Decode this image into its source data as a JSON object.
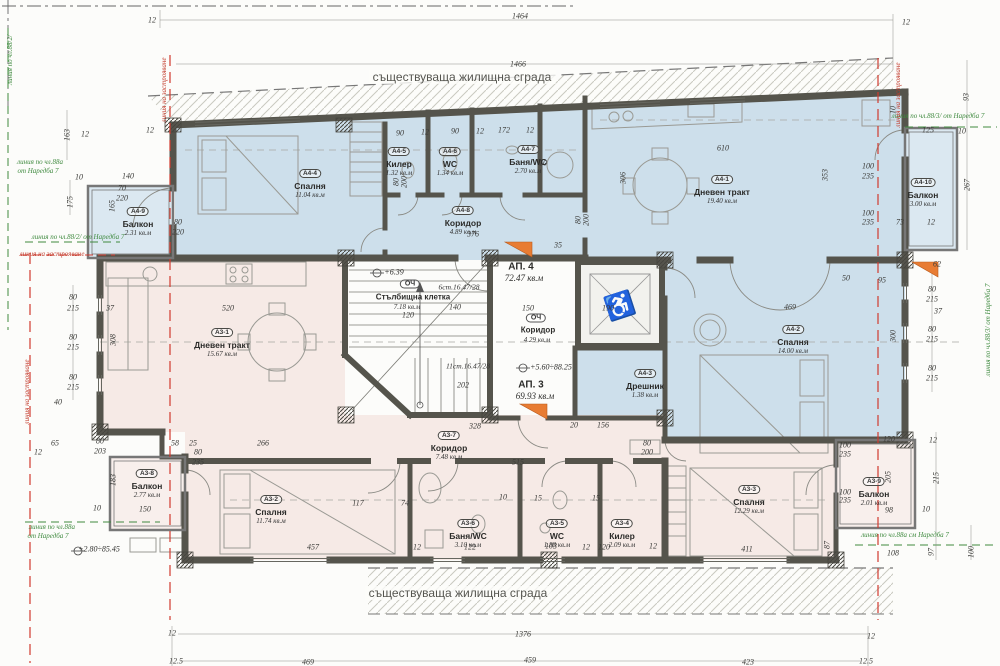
{
  "texts": {
    "existing_top": "съществуваща жилищна сграда",
    "existing_bottom": "съществуваща жилищна сграда"
  },
  "colors": {
    "apartment4_fill": "#cddfeb",
    "apartment3_fill": "#f6eae6",
    "wall": "#55544c",
    "regulation_green": "#3f8a3f",
    "building_line_red": "#c23b2c",
    "section_marker_orange": "#e87c33"
  },
  "apartments": [
    {
      "label": "АП. 4",
      "area": "72.47 кв.м"
    },
    {
      "label": "АП. 3",
      "area": "69.93 кв.м"
    }
  ],
  "rooms": [
    {
      "id": "A4-1",
      "name": "Дневен тракт",
      "area": "19.40 кв.м",
      "x": 722,
      "y": 168
    },
    {
      "id": "A4-2",
      "name": "Спалня",
      "area": "14.00 кв.м",
      "x": 793,
      "y": 318
    },
    {
      "id": "A4-3",
      "name": "Дрешник",
      "area": "1.38 кв.м",
      "x": 645,
      "y": 362
    },
    {
      "id": "A4-4",
      "name": "Спалня",
      "area": "11.04 кв.м",
      "x": 310,
      "y": 162
    },
    {
      "id": "A4-5",
      "name": "Килер",
      "area": "1.32 кв.м",
      "x": 399,
      "y": 140
    },
    {
      "id": "A4-6",
      "name": "WC",
      "area": "1.34 кв.м",
      "x": 450,
      "y": 140
    },
    {
      "id": "A4-7",
      "name": "Баня/WC",
      "area": "2.70 кв.м",
      "x": 528,
      "y": 138
    },
    {
      "id": "A4-8",
      "name": "Коридор",
      "area": "4.89 кв.м",
      "x": 463,
      "y": 199
    },
    {
      "id": "A4-9",
      "name": "Балкон",
      "area": "2.31 кв.м",
      "x": 138,
      "y": 200
    },
    {
      "id": "A4-10",
      "name": "Балкон",
      "area": "3.00 кв.м",
      "x": 923,
      "y": 171
    },
    {
      "id": "A3-1",
      "name": "Дневен тракт",
      "area": "15.67 кв.м",
      "x": 222,
      "y": 321
    },
    {
      "id": "A3-2",
      "name": "Спалня",
      "area": "11.74 кв.м",
      "x": 271,
      "y": 488
    },
    {
      "id": "A3-3",
      "name": "Спалня",
      "area": "12.29 кв.м",
      "x": 749,
      "y": 478
    },
    {
      "id": "A3-4",
      "name": "Килер",
      "area": "2.09 кв.м",
      "x": 622,
      "y": 512
    },
    {
      "id": "A3-5",
      "name": "WC",
      "area": "1.88 кв.м",
      "x": 557,
      "y": 512
    },
    {
      "id": "A3-6",
      "name": "Баня/WC",
      "area": "3.10 кв.м",
      "x": 468,
      "y": 512
    },
    {
      "id": "A3-7",
      "name": "Коридор",
      "area": "7.48 кв.м",
      "x": 449,
      "y": 424
    },
    {
      "id": "A3-8",
      "name": "Балкон",
      "area": "2.77 кв.м",
      "x": 147,
      "y": 462
    },
    {
      "id": "A3-9",
      "name": "Балкон",
      "area": "2.01 кв.м",
      "x": 874,
      "y": 470
    }
  ],
  "labels": [
    [
      "АП. 4",
      521,
      267,
      "a"
    ],
    [
      "72.47 кв.м",
      524,
      278,
      "aa"
    ],
    [
      "АП. 3",
      531,
      385,
      "a"
    ],
    [
      "69.93 кв.м",
      535,
      396,
      "aa"
    ],
    [
      "Стълбищна клетка",
      413,
      297,
      "c"
    ],
    [
      "7.18 кв.м",
      407,
      307,
      "ca"
    ],
    [
      "Коридор",
      538,
      330,
      "c"
    ],
    [
      "4.29 кв.м",
      537,
      340,
      "ca"
    ],
    [
      "ОЧ",
      410,
      284,
      "o"
    ],
    [
      "ОЧ",
      536,
      318,
      "o"
    ],
    [
      "6ст.16.47/28",
      459,
      287,
      "n"
    ],
    [
      "11ст.16.47/28",
      468,
      366,
      "n"
    ],
    [
      "+6.39",
      394,
      272,
      "l"
    ],
    [
      "+5.60÷88.25",
      551,
      367,
      "l"
    ],
    [
      "+2.80÷85.45",
      99,
      549,
      "l"
    ],
    [
      "линия по чл.88а",
      40,
      162,
      "g"
    ],
    [
      "от Наредба 7",
      38,
      171,
      "g"
    ],
    [
      "линия по чл.88/2/ от Наредба 7",
      78,
      237,
      "g"
    ],
    [
      "линия по чл.88а",
      52,
      527,
      "g"
    ],
    [
      "от Наредба 7",
      48,
      536,
      "g"
    ],
    [
      "линия по чл.88/3/ от Наредба 7",
      938,
      116,
      "g"
    ],
    [
      "линия по чл.88/3/ от Наредба 7",
      988,
      330,
      "g",
      -90
    ],
    [
      "линия по чл.88а см Наредба 7",
      905,
      535,
      "g"
    ],
    [
      "линия по чл.88/2/",
      10,
      60,
      "g",
      -90
    ],
    [
      "линия на застрояване",
      164,
      90,
      "r",
      -90
    ],
    [
      "линия на застрояване",
      52,
      254,
      "r"
    ],
    [
      "линия на застрояване",
      27,
      392,
      "r",
      -90
    ],
    [
      "линия на застрояване",
      898,
      95,
      "r",
      -90
    ],
    [
      "12",
      152,
      20,
      "d"
    ],
    [
      "1464",
      520,
      16,
      "d"
    ],
    [
      "1466",
      518,
      64,
      "d"
    ],
    [
      "12",
      906,
      22,
      "d"
    ],
    [
      "93",
      966,
      97,
      "d",
      -90
    ],
    [
      "10",
      893,
      110,
      "d",
      -90
    ],
    [
      "125",
      928,
      130,
      "d"
    ],
    [
      "10",
      962,
      131,
      "d"
    ],
    [
      "267",
      967,
      185,
      "d",
      -90
    ],
    [
      "73",
      900,
      222,
      "d"
    ],
    [
      "12",
      931,
      222,
      "d"
    ],
    [
      "100",
      868,
      166,
      "d"
    ],
    [
      "235",
      868,
      176,
      "d"
    ],
    [
      "100",
      868,
      213,
      "d"
    ],
    [
      "235",
      868,
      222,
      "d"
    ],
    [
      "62",
      937,
      264,
      "d"
    ],
    [
      "80",
      932,
      289,
      "d"
    ],
    [
      "215",
      932,
      299,
      "d"
    ],
    [
      "37",
      938,
      311,
      "d"
    ],
    [
      "80",
      932,
      329,
      "d"
    ],
    [
      "215",
      932,
      339,
      "d"
    ],
    [
      "300",
      893,
      336,
      "d",
      -90
    ],
    [
      "80",
      932,
      368,
      "d"
    ],
    [
      "215",
      932,
      378,
      "d"
    ],
    [
      "469",
      790,
      307,
      "d"
    ],
    [
      "50",
      846,
      278,
      "d"
    ],
    [
      "95",
      882,
      280,
      "d"
    ],
    [
      "120",
      889,
      439,
      "d"
    ],
    [
      "12",
      933,
      440,
      "d"
    ],
    [
      "100",
      845,
      445,
      "d"
    ],
    [
      "235",
      845,
      454,
      "d"
    ],
    [
      "205",
      888,
      477,
      "d",
      -90
    ],
    [
      "215",
      936,
      478,
      "d",
      -90
    ],
    [
      "100",
      845,
      492,
      "d"
    ],
    [
      "235",
      845,
      500,
      "d"
    ],
    [
      "98",
      889,
      510,
      "d"
    ],
    [
      "10",
      926,
      509,
      "d"
    ],
    [
      "97",
      931,
      552,
      "d",
      -90
    ],
    [
      "100",
      971,
      552,
      "d",
      -90
    ],
    [
      "108",
      893,
      553,
      "d"
    ],
    [
      "411",
      747,
      549,
      "d"
    ],
    [
      "87",
      827,
      545,
      "d",
      -90
    ],
    [
      "457",
      313,
      547,
      "d"
    ],
    [
      "12",
      172,
      633,
      "d"
    ],
    [
      "1376",
      523,
      634,
      "d"
    ],
    [
      "12",
      871,
      636,
      "d"
    ],
    [
      "12.5",
      176,
      661,
      "d"
    ],
    [
      "469",
      308,
      662,
      "d"
    ],
    [
      "459",
      530,
      660,
      "d"
    ],
    [
      "423",
      748,
      662,
      "d"
    ],
    [
      "12.5",
      866,
      661,
      "d"
    ],
    [
      "163",
      67,
      135,
      "d",
      -90
    ],
    [
      "12",
      150,
      130,
      "d"
    ],
    [
      "12",
      85,
      134,
      "d"
    ],
    [
      "10",
      79,
      177,
      "d"
    ],
    [
      "140",
      128,
      176,
      "d"
    ],
    [
      "70",
      122,
      188,
      "d"
    ],
    [
      "220",
      122,
      198,
      "d"
    ],
    [
      "175",
      70,
      202,
      "d",
      -90
    ],
    [
      "80",
      178,
      222,
      "d"
    ],
    [
      "220",
      178,
      232,
      "d"
    ],
    [
      "165",
      112,
      206,
      "d",
      -90
    ],
    [
      "80",
      73,
      297,
      "d"
    ],
    [
      "215",
      73,
      308,
      "d"
    ],
    [
      "80",
      73,
      337,
      "d"
    ],
    [
      "215",
      73,
      347,
      "d"
    ],
    [
      "80",
      73,
      377,
      "d"
    ],
    [
      "215",
      73,
      387,
      "d"
    ],
    [
      "40",
      58,
      402,
      "d"
    ],
    [
      "65",
      55,
      443,
      "d"
    ],
    [
      "12",
      38,
      452,
      "d"
    ],
    [
      "80",
      100,
      441,
      "d"
    ],
    [
      "203",
      100,
      451,
      "d"
    ],
    [
      "58",
      175,
      443,
      "d"
    ],
    [
      "25",
      193,
      443,
      "d"
    ],
    [
      "80",
      198,
      452,
      "d"
    ],
    [
      "235",
      198,
      462,
      "d"
    ],
    [
      "150",
      145,
      509,
      "d"
    ],
    [
      "10",
      97,
      508,
      "d"
    ],
    [
      "183",
      113,
      480,
      "d",
      -90
    ],
    [
      "90",
      400,
      133,
      "d"
    ],
    [
      "12",
      425,
      132,
      "d"
    ],
    [
      "90",
      455,
      131,
      "d"
    ],
    [
      "12",
      480,
      131,
      "d"
    ],
    [
      "172",
      504,
      130,
      "d"
    ],
    [
      "12",
      530,
      130,
      "d"
    ],
    [
      "10",
      543,
      163,
      "d"
    ],
    [
      "80",
      396,
      182,
      "d",
      -90
    ],
    [
      "200",
      404,
      182,
      "d",
      -90
    ],
    [
      "80",
      578,
      220,
      "d",
      -90
    ],
    [
      "200",
      586,
      220,
      "d",
      -90
    ],
    [
      "376",
      473,
      234,
      "d"
    ],
    [
      "150",
      528,
      308,
      "d"
    ],
    [
      "140",
      455,
      307,
      "d"
    ],
    [
      "190",
      608,
      308,
      "d"
    ],
    [
      "202",
      463,
      385,
      "d"
    ],
    [
      "120",
      408,
      315,
      "d"
    ],
    [
      "35",
      558,
      245,
      "d"
    ],
    [
      "328",
      475,
      426,
      "d"
    ],
    [
      "20",
      574,
      425,
      "d"
    ],
    [
      "156",
      603,
      425,
      "d"
    ],
    [
      "80",
      647,
      443,
      "d"
    ],
    [
      "200",
      647,
      452,
      "d"
    ],
    [
      "515",
      518,
      462,
      "d"
    ],
    [
      "10",
      503,
      497,
      "d"
    ],
    [
      "15",
      538,
      498,
      "d"
    ],
    [
      "15",
      596,
      498,
      "d"
    ],
    [
      "12",
      417,
      547,
      "d"
    ],
    [
      "122",
      470,
      547,
      "d"
    ],
    [
      "103",
      551,
      546,
      "d"
    ],
    [
      "12",
      586,
      547,
      "d"
    ],
    [
      "120",
      604,
      547,
      "d"
    ],
    [
      "12",
      653,
      546,
      "d"
    ],
    [
      "117",
      358,
      503,
      "d"
    ],
    [
      "74",
      405,
      503,
      "d"
    ],
    [
      "266",
      263,
      443,
      "d"
    ],
    [
      "308",
      113,
      340,
      "d",
      -90
    ],
    [
      "37",
      110,
      308,
      "d"
    ],
    [
      "520",
      228,
      308,
      "d"
    ],
    [
      "306",
      623,
      178,
      "d",
      -90
    ],
    [
      "610",
      723,
      148,
      "d"
    ],
    [
      "353",
      825,
      175,
      "d",
      -90
    ]
  ]
}
